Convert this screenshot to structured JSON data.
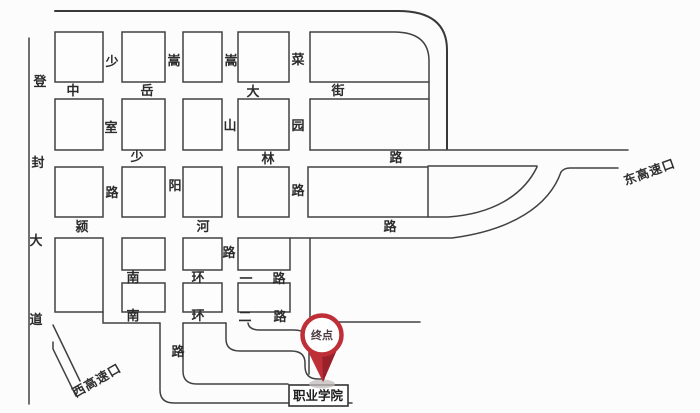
{
  "map": {
    "type": "schematic-road-map",
    "streets": {
      "dengfeng_avenue": {
        "name": "登封大道",
        "chars": [
          "登",
          "封",
          "大",
          "道"
        ]
      },
      "zhongyue_street": {
        "name": "中岳大街",
        "chars": [
          "中",
          "岳",
          "大",
          "街"
        ]
      },
      "shaoshi_road": {
        "name": "少室路",
        "chars": [
          "少",
          "室",
          "路"
        ]
      },
      "songyang_road": {
        "name": "嵩阳路",
        "chars": [
          "嵩",
          "阳",
          "路"
        ]
      },
      "songshan_road": {
        "name": "嵩山路",
        "chars": [
          "嵩",
          "山",
          "路"
        ]
      },
      "caiyuan_road": {
        "name": "菜园路",
        "chars": [
          "菜",
          "园",
          "路"
        ]
      },
      "shaolin_road": {
        "name": "少林路",
        "chars": [
          "少",
          "林",
          "路"
        ]
      },
      "yinghe_road": {
        "name": "颍河路",
        "chars": [
          "颍",
          "河",
          "路"
        ]
      },
      "nanhuan_first": {
        "name": "南环一路",
        "chars": [
          "南",
          "环",
          "一",
          "路"
        ]
      },
      "nanhuan_second": {
        "name": "南环二路",
        "chars": [
          "南",
          "环",
          "二",
          "路"
        ]
      }
    },
    "exits": {
      "east_expressway_exit": "东高速口",
      "west_expressway_exit": "西高速口"
    },
    "marker": {
      "label": "终点"
    },
    "destination": {
      "label": "职业学院"
    },
    "colors": {
      "pin_red": "#bf2f38",
      "pin_dark_red": "#99212b",
      "line": "#414141",
      "background": "#fcfcfc"
    }
  }
}
